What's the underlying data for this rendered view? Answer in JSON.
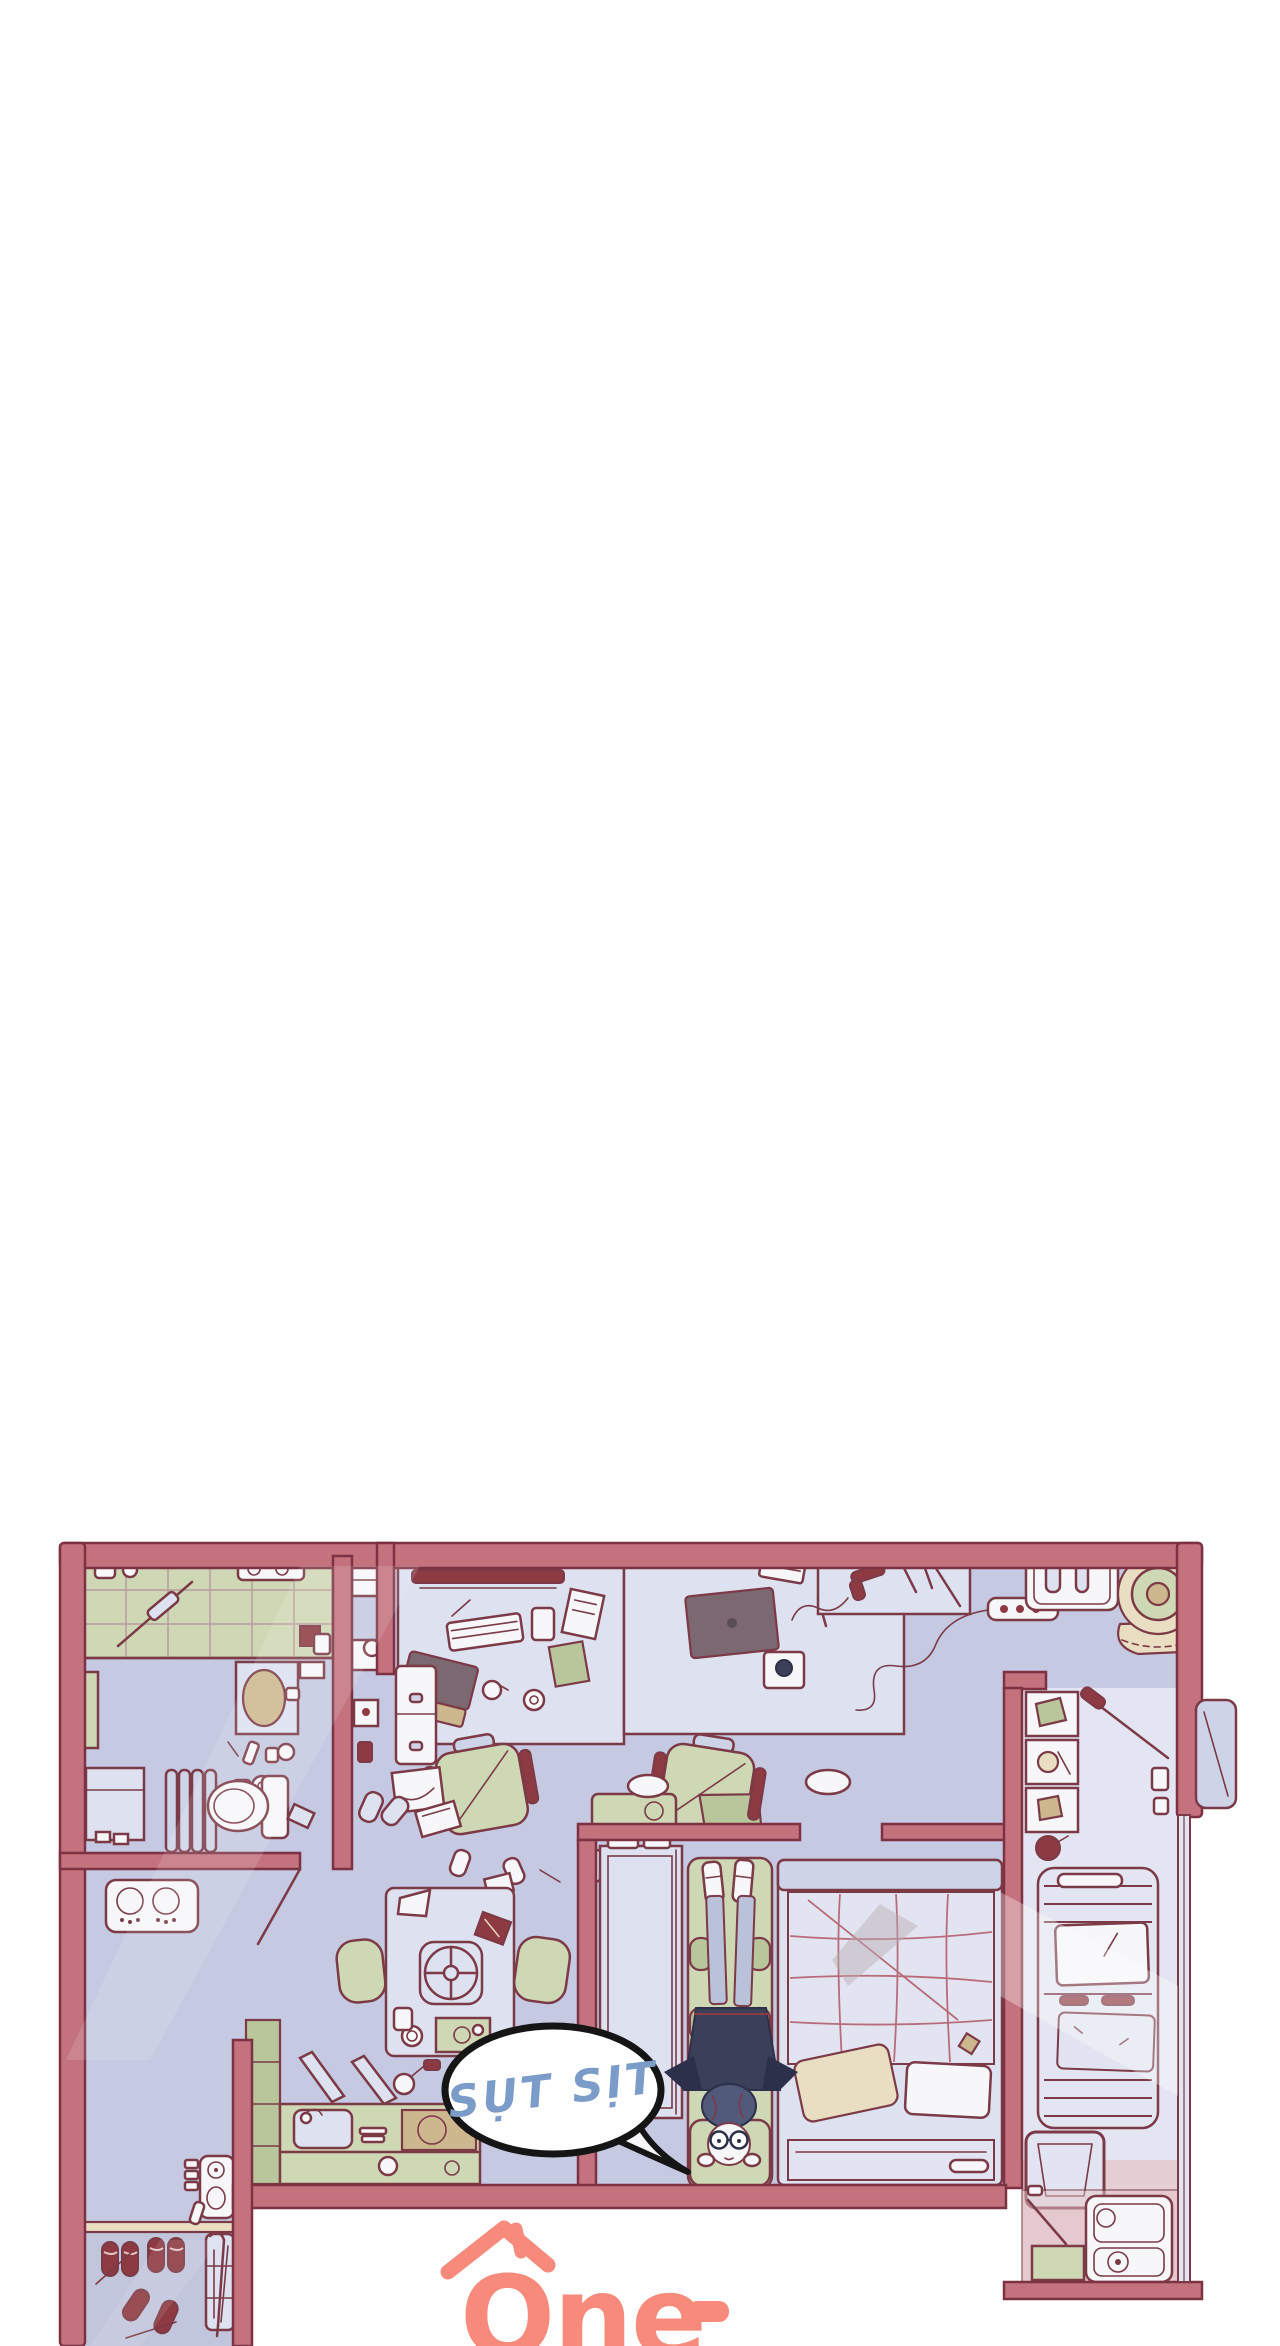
{
  "page": {
    "width": 1280,
    "height": 2346,
    "background": "#ffffff"
  },
  "panel": {
    "kind": "webtoon-floorplan-panel",
    "speech_bubble": {
      "text": "SỤT SỊT",
      "text_color": "#7b9cc9",
      "fill": "#ffffff",
      "outline": "#151515"
    },
    "logo": {
      "text": "One",
      "dash": "-",
      "color": "#f78a7b",
      "icon": "house-roof-icon"
    }
  },
  "palette": {
    "page_bg": "#ffffff",
    "wall": "#c4737e",
    "wall_outline": "#7c3242",
    "line": "#7b3a46",
    "floor": "#c5c9e2",
    "floor_light": "#e2e5f1",
    "green": "#cfd8b5",
    "green_dark": "#b9c69b",
    "furniture": "#ced4e8",
    "furniture_light": "#dde1f0",
    "white": "#f7f7fa",
    "tan": "#cdb78e",
    "cream": "#e9ddc2",
    "navy": "#3b4059",
    "navy_dark": "#2c3048",
    "denim": "#b9c2d9",
    "hair": "#525a7c",
    "red_item": "#8e3a42",
    "balcony_pink": "#e6c6ca",
    "screen_dark": "#7b6871",
    "quilt_line": "#b4606b",
    "tile_line": "#b99aa0",
    "bubble_blue": "#7b9cc9",
    "logo_coral": "#f78a7b",
    "genkan": "#c2c6dc"
  }
}
